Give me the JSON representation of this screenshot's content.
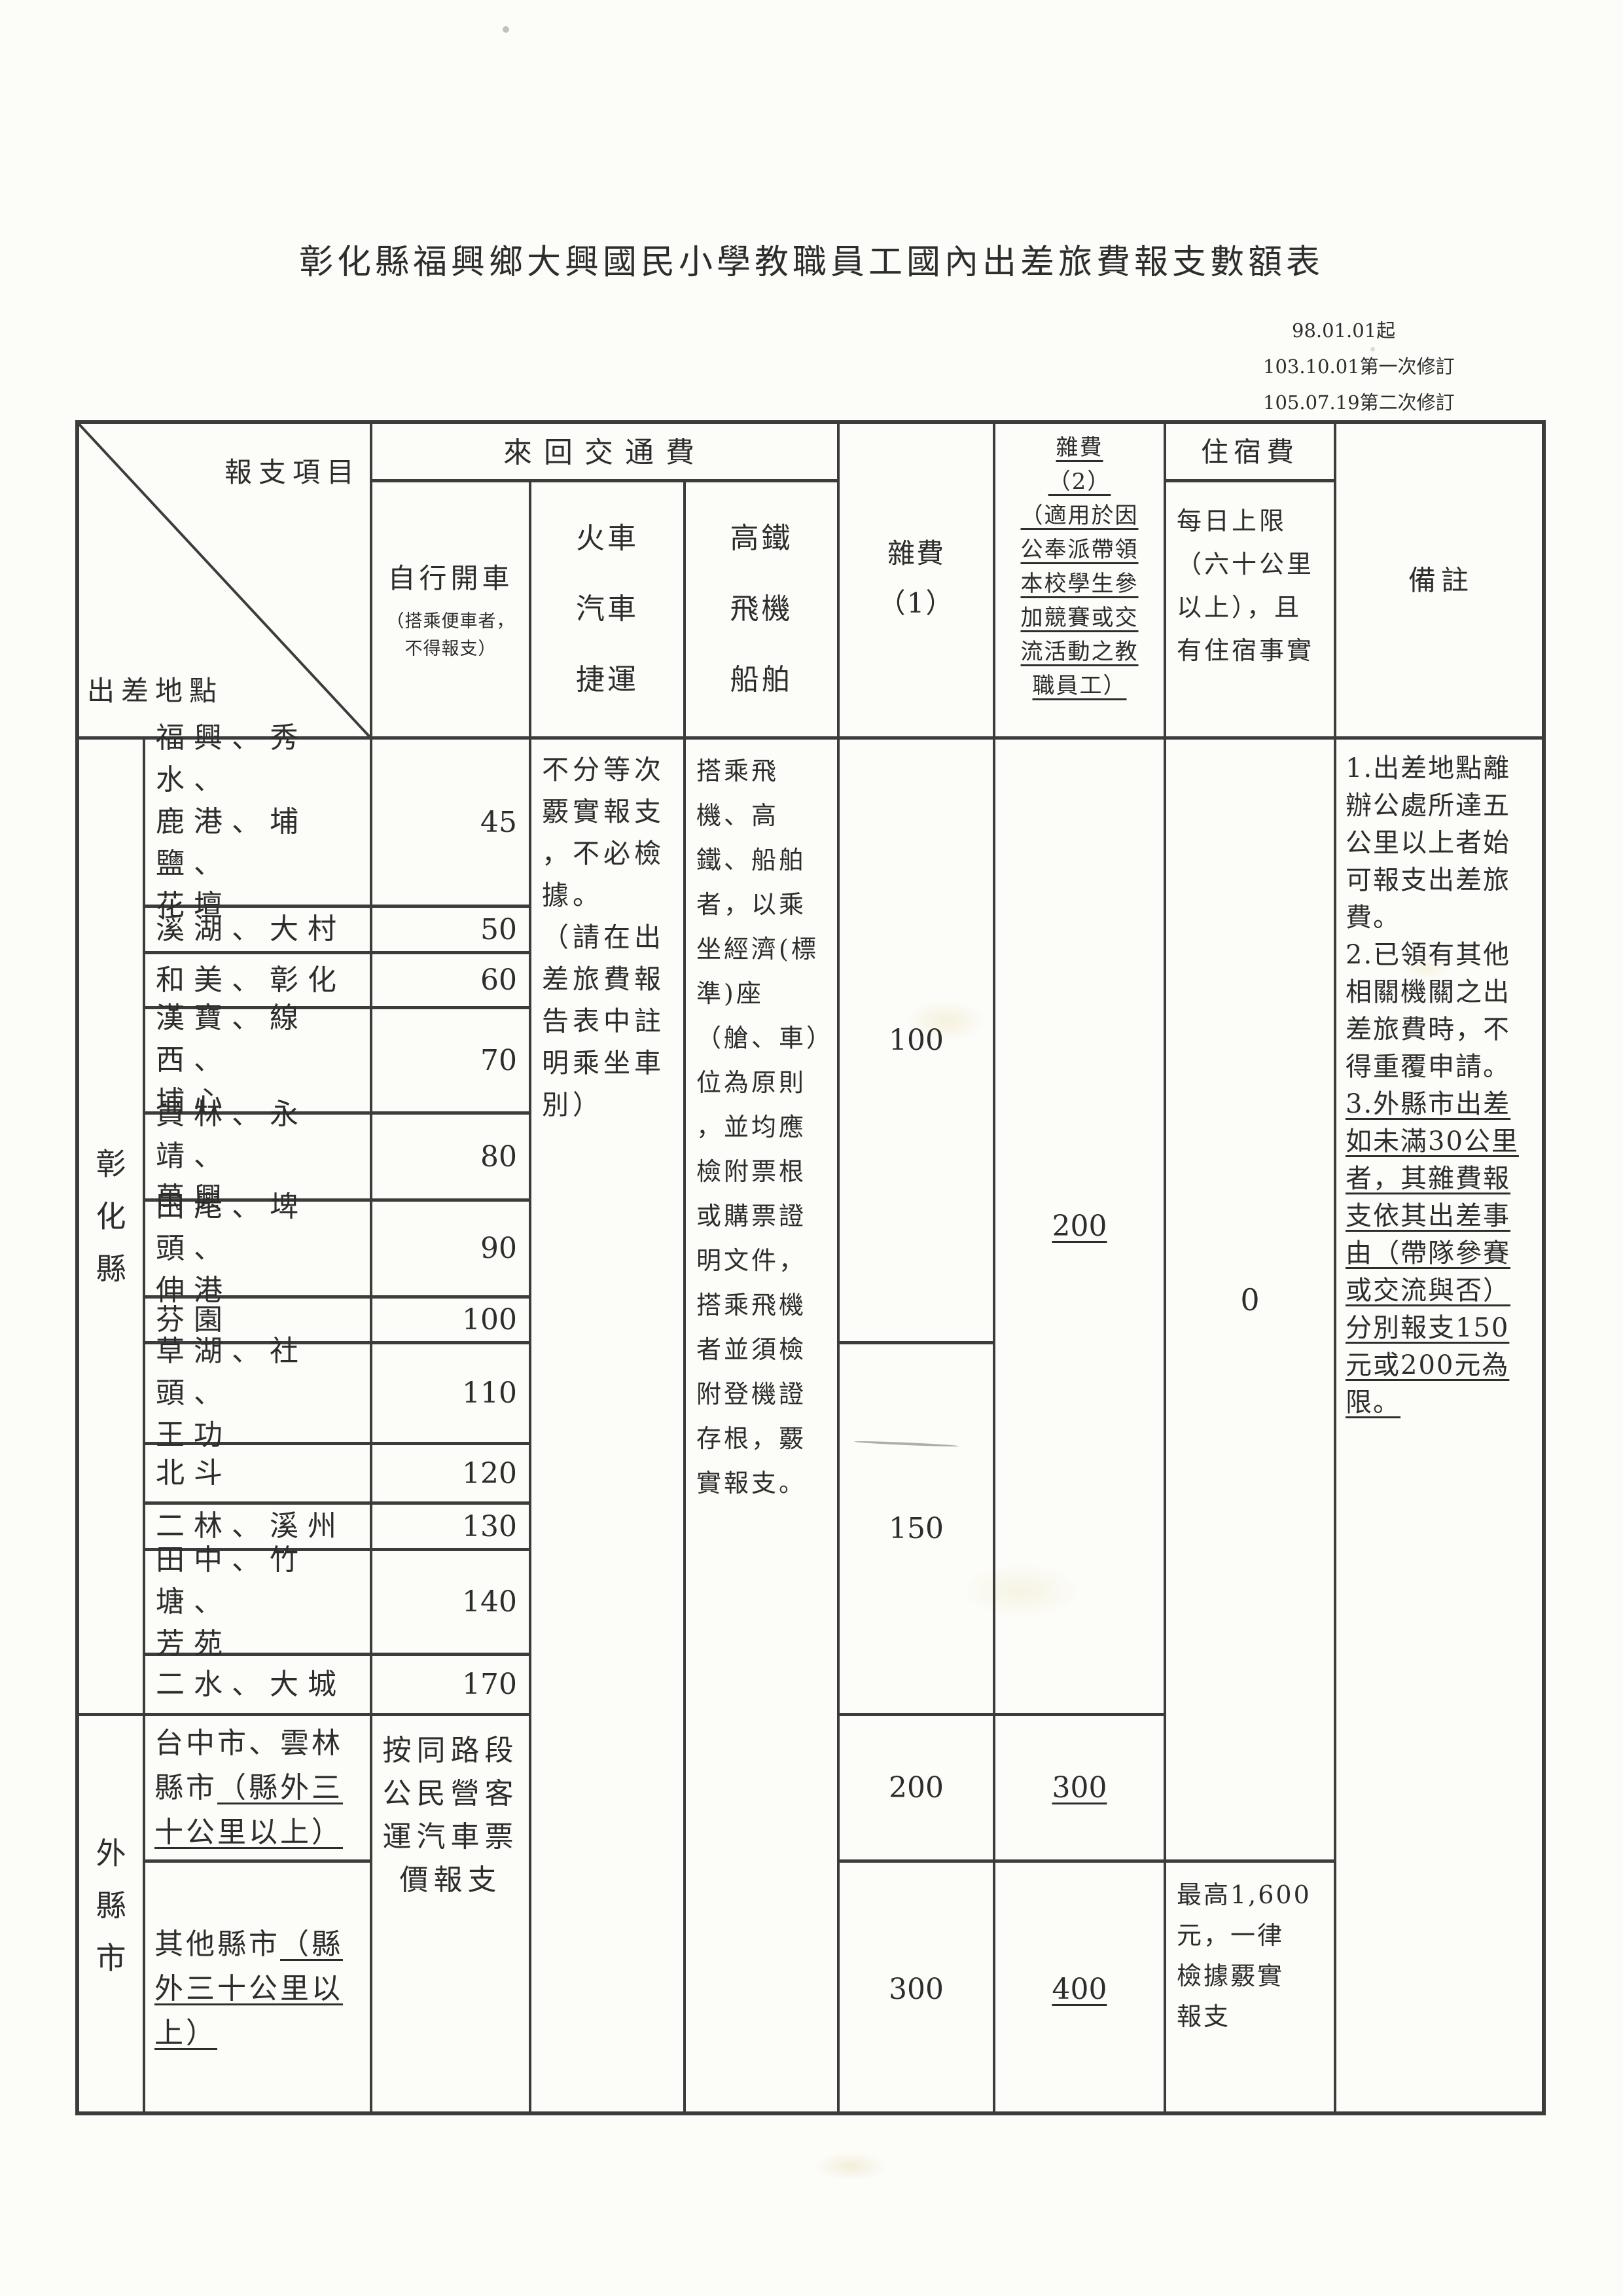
{
  "title": "彰化縣福興鄉大興國民小學教職員工國內出差旅費報支數額表",
  "revisions": [
    "98.01.01起",
    "103.10.01第一次修訂",
    "105.07.19第二次修訂"
  ],
  "header": {
    "item_label": "報支項目",
    "place_label": "出差地點",
    "transport_group": "來回交通費",
    "own_car_title": "自行開車",
    "own_car_note": [
      "（搭乘便車者，",
      "不得報支）"
    ],
    "train": [
      "火車",
      "汽車",
      "捷運"
    ],
    "hsr": [
      "高鐵",
      "飛機",
      "船舶"
    ],
    "misc1": [
      "雜費",
      "（1）"
    ],
    "misc2": [
      {
        "t": "雜費",
        "u": 1
      },
      {
        "t": "（2）",
        "u": 1
      },
      {
        "t": "（適用於因",
        "u": 1
      },
      {
        "t": "公奉派帶領",
        "u": 1
      },
      {
        "t": "本校學生參",
        "u": 1
      },
      {
        "t": "加競賽或交",
        "u": 1
      },
      {
        "t": "流活動之教",
        "u": 1
      },
      {
        "t": "職員工）",
        "u": 1
      }
    ],
    "lodging_title": "住宿費",
    "lodging_sub": [
      "每日上限",
      "（六十公里",
      "以上），且",
      "有住宿事實"
    ],
    "notes": "備註"
  },
  "groups": [
    {
      "label": "彰化縣"
    },
    {
      "label": "外縣市"
    }
  ],
  "rows": [
    {
      "location": [
        "福興、秀水、",
        "鹿港、埔鹽、",
        "花壇"
      ],
      "fee": "45"
    },
    {
      "location": [
        "溪湖、大村"
      ],
      "fee": "50"
    },
    {
      "location": [
        "和美、彰化"
      ],
      "fee": "60"
    },
    {
      "location": [
        "漢寶、線西、",
        "埔心"
      ],
      "fee": "70"
    },
    {
      "location": [
        "員林、永靖、",
        "萬興"
      ],
      "fee": "80"
    },
    {
      "location": [
        "田尾、埤頭、",
        "伸港"
      ],
      "fee": "90"
    },
    {
      "location": [
        "芬園"
      ],
      "fee": "100"
    },
    {
      "location": [
        "草湖、社頭、",
        "王功"
      ],
      "fee": "110"
    },
    {
      "location": [
        "北斗"
      ],
      "fee": "120"
    },
    {
      "location": [
        "二林、溪州"
      ],
      "fee": "130"
    },
    {
      "location": [
        "田中、竹塘、",
        "芳苑"
      ],
      "fee": "140"
    },
    {
      "location": [
        "二水、大城"
      ],
      "fee": "170"
    },
    {
      "location": [
        [
          "台中市、雲林"
        ],
        [
          "縣市",
          {
            "t": "（縣外三",
            "u": 1
          }
        ],
        [
          {
            "t": "十公里以上）",
            "u": 1
          }
        ]
      ]
    },
    {
      "location": [
        [
          "其他縣市",
          {
            "t": "（縣",
            "u": 1
          }
        ],
        [
          {
            "t": "外三十公里以",
            "u": 1
          }
        ],
        [
          {
            "t": "上）",
            "u": 1
          }
        ]
      ]
    }
  ],
  "body": {
    "own_car_other": [
      "按同路段",
      "公民營客",
      "運汽車票",
      "價報支"
    ],
    "train_note": [
      "不分等次",
      "覈實報支",
      "，不必檢",
      "據。",
      "（請在出",
      "差旅費報",
      "告表中註",
      "明乘坐車",
      "別）"
    ],
    "hsr_note": [
      "搭乘飛",
      "機、高",
      "鐵、船舶",
      "者，以乘",
      "坐經濟(標",
      "準)座",
      "（艙、車）",
      "位為原則",
      "，並均應",
      "檢附票根",
      "或購票證",
      "明文件，",
      "搭乘飛機",
      "者並須檢",
      "附登機證",
      "存根，覈",
      "實報支。"
    ],
    "misc1": [
      "100",
      "150",
      "200",
      "300"
    ],
    "misc2": [
      "200",
      "300",
      "400"
    ],
    "lodging_zero": "0",
    "lodging_max": [
      "最高1,600",
      "元，一律",
      "檢據覈實",
      "報支"
    ],
    "notes": [
      "1.出差地點離",
      "辦公處所達五",
      "公里以上者始",
      "可報支出差旅",
      "費。",
      "2.已領有其他",
      "相關機關之出",
      "差旅費時，不",
      "得重覆申請。",
      {
        "t": "3.外縣市出差",
        "u": 1
      },
      {
        "t": "如未滿30公里",
        "u": 1
      },
      {
        "t": "者，其雜費報",
        "u": 1
      },
      {
        "t": "支依其出差事",
        "u": 1
      },
      {
        "t": "由（帶隊參賽",
        "u": 1
      },
      {
        "t": "或交流與否）",
        "u": 1
      },
      {
        "t": "分別報支150",
        "u": 1
      },
      {
        "t": "元或200元為",
        "u": 1
      },
      {
        "t": "限。",
        "u": 1
      }
    ]
  }
}
